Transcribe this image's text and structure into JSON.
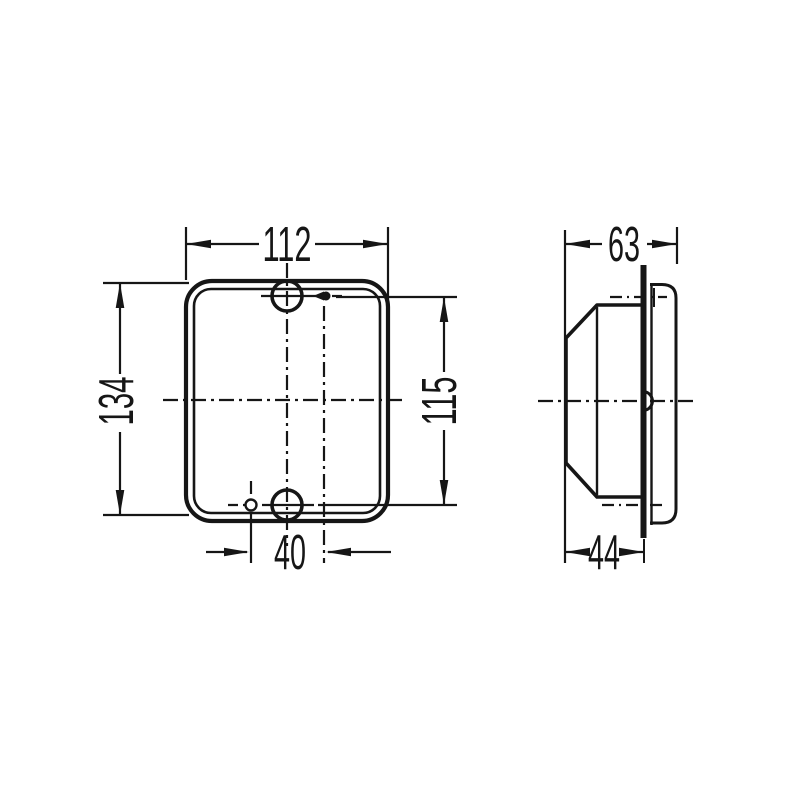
{
  "colors": {
    "background": "#ffffff",
    "line": "#161616"
  },
  "views": {
    "front": {
      "dim_width": "112",
      "dim_height": "134",
      "dim_hole_pitch_vertical": "115",
      "dim_hole_pitch_horizontal": "40"
    },
    "side": {
      "dim_depth_total": "63",
      "dim_depth_mounting": "44"
    }
  }
}
